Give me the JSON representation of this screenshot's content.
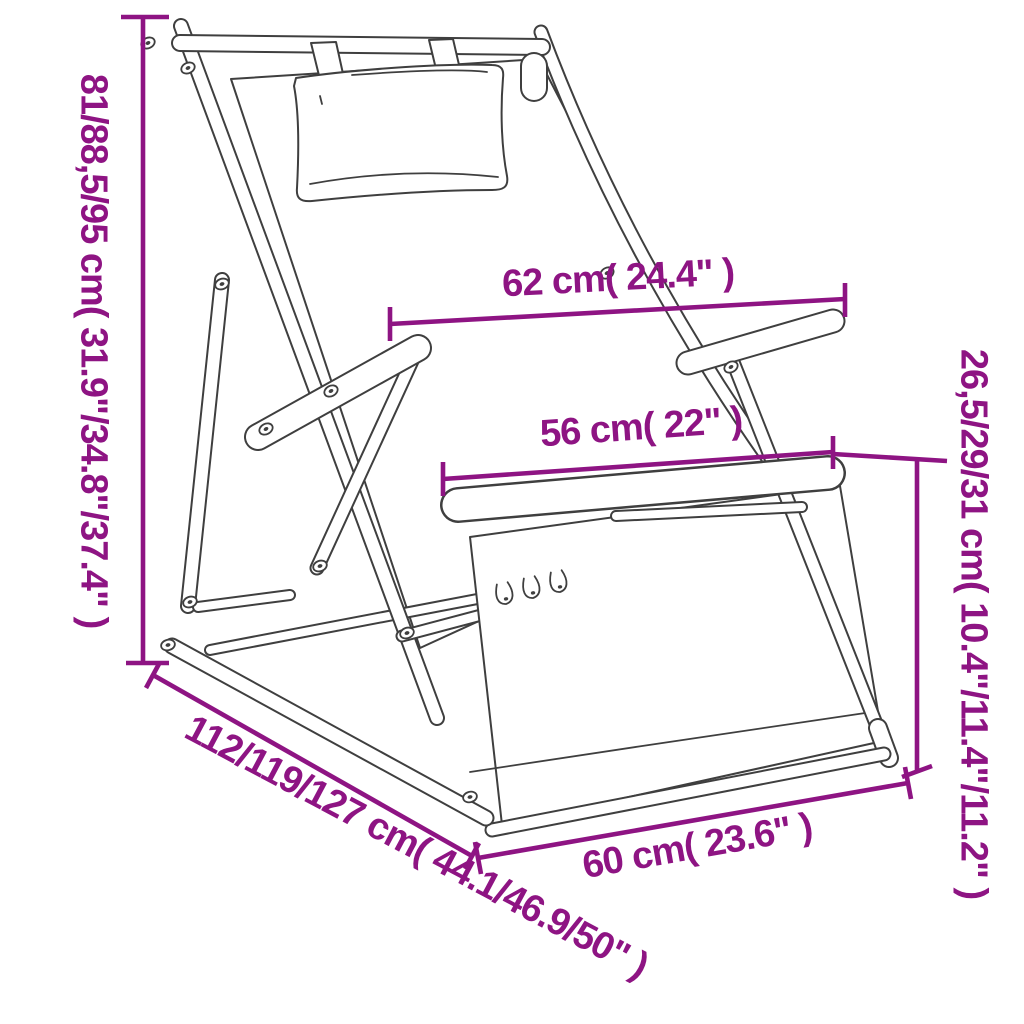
{
  "page": {
    "background_color": "#ffffff",
    "content_type": "product dimension diagram",
    "product": "folding wooden deck chair with headrest pillow"
  },
  "diagram": {
    "accent_color": "#8e1483",
    "line_color": "#3f3f3f",
    "labels": {
      "height": "81/88,5/95 cm( 31.9\"/34.8\"/37.4\" )",
      "back_width": "62 cm( 24.4\" )",
      "seat_width": "56 cm( 22\" )",
      "seat_height": "26,5/29/31 cm( 10.4\"/11.4\"/11.2\" )",
      "depth": "112/119/127 cm( 44.1/46.9/50\" )",
      "front_width": "60 cm( 23.6\" )"
    }
  }
}
